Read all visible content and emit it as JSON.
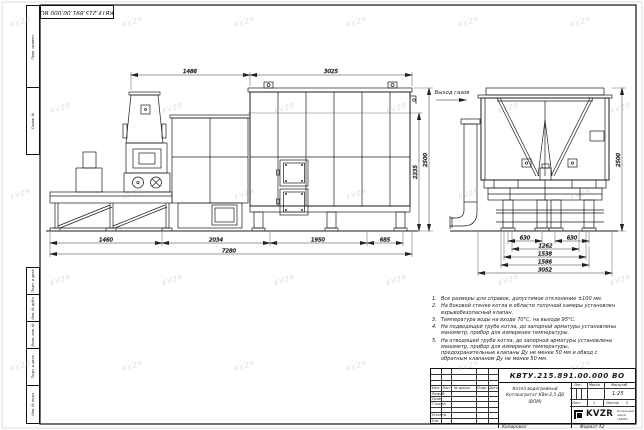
{
  "page": {
    "stamp_rotated": "КВТУ.215.891.00.000 ВО",
    "footer_copied": "Копировал",
    "footer_format": "Формат А2"
  },
  "watermark": {
    "text": "KVZR"
  },
  "labels": {
    "gas_outlet": "Выход газов"
  },
  "dims": {
    "front": {
      "top": [
        "1486",
        "3025"
      ],
      "bottom": [
        "1460",
        "2034",
        "1950",
        "685"
      ],
      "total": "7280",
      "heights": [
        "2235",
        "2500"
      ]
    },
    "side": {
      "top": [
        "630",
        "630"
      ],
      "mid": [
        "1262",
        "1538",
        "1586"
      ],
      "total": "3052",
      "height": "2500"
    }
  },
  "notes": [
    {
      "num": "1.",
      "text": "Все размеры для справок, допустимое отклонение ±100 мм."
    },
    {
      "num": "2.",
      "text": "На боковой стенке котла в области топочной камеры установлен взрывобезопасный клапан."
    },
    {
      "num": "3.",
      "text": "Температура воды на входе 70°С, на выходе 95°С."
    },
    {
      "num": "4.",
      "text": "На подводящей трубе котла, до запорной арматуры установлены манометр, прибор для измерения температуры."
    },
    {
      "num": "5.",
      "text": "На отводящей трубе котла, до запорной арматуры установлены манометр, прибор для измерения температуры, предохранительные клапаны Ду не менее 50 мм и обвод с обратным клапаном Ду не менее 50 мм."
    }
  ],
  "margin_stamps_top": [
    "Перв. примен.",
    "Справ. №"
  ],
  "margin_stamps_bottom": [
    "Подп. и дата",
    "Инв. № дубл.",
    "Взам. инв. №",
    "Подп. и дата",
    "Инв. № подл."
  ],
  "title_block": {
    "designation": "КВТУ.215.891.00.000 ВО",
    "name_line1": "Котел водогрейный",
    "name_line2": "Котлоагрегат КВм-2,5-ДВ (ВПМ)",
    "change_header": [
      "Изм.",
      "Лист",
      "№ докум.",
      "Подп.",
      "Дата"
    ],
    "sign_rows": [
      "Разраб.",
      "Пров.",
      "Т.контр.",
      "Н.контр.",
      "Утв."
    ],
    "lit_label": "Лит.",
    "mass_label": "Масса",
    "scale_label": "Масштаб",
    "scale_value": "1:25",
    "sheet_label": "Лист",
    "sheet_value": "1",
    "sheets_label": "Листов",
    "sheets_value": "2",
    "logo": "KVZR",
    "company_line1": "Котельный завод",
    "company_line2": "«КВЗР»"
  }
}
